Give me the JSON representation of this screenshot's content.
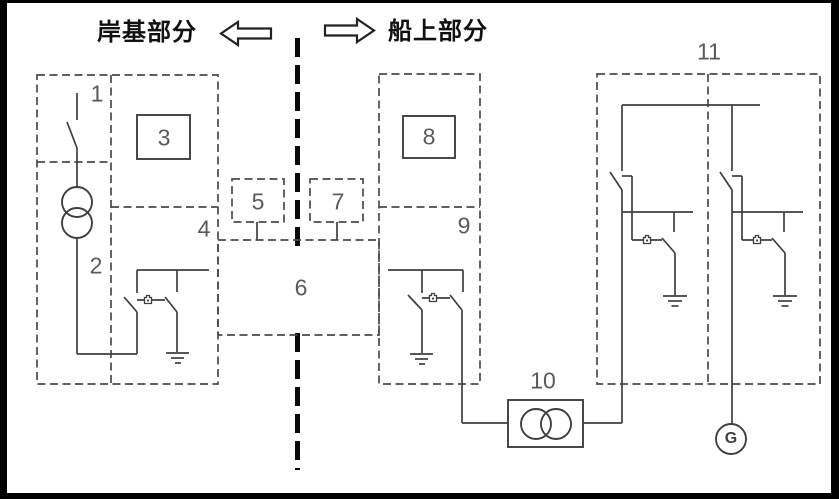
{
  "diagram": {
    "shore_title": "岸基部分",
    "ship_title": "船上部分",
    "generator_label": "G",
    "numbers": {
      "n1": "1",
      "n2": "2",
      "n3": "3",
      "n4": "4",
      "n5": "5",
      "n6": "6",
      "n7": "7",
      "n8": "8",
      "n9": "9",
      "n10": "10",
      "n11": "11"
    },
    "colors": {
      "line": "#3f3f3f",
      "dashed_line": "#4a4a4a",
      "separator_line": "#0a0a0a",
      "number_text": "#5a5a5a",
      "title_text": "#111111",
      "frame": "#000000",
      "background": "#ffffff"
    }
  }
}
